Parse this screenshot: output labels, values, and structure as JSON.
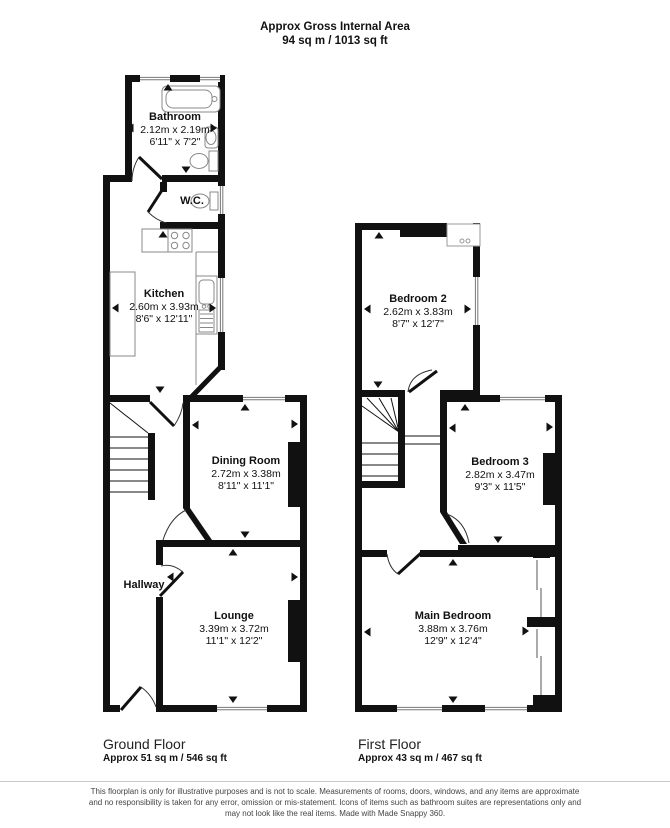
{
  "header": {
    "title": "Approx Gross Internal Area",
    "area": "94 sq m / 1013 sq ft"
  },
  "ground_floor": {
    "title": "Ground Floor",
    "area": "Approx 51 sq m / 546 sq ft",
    "rooms": {
      "bathroom": {
        "name": "Bathroom",
        "metric": "2.12m x 2.19m",
        "imperial": "6'11\" x 7'2\""
      },
      "wc": {
        "name": "W.C."
      },
      "kitchen": {
        "name": "Kitchen",
        "metric": "2.60m x 3.93m",
        "imperial": "8'6\" x 12'11\""
      },
      "dining_room": {
        "name": "Dining Room",
        "metric": "2.72m x 3.38m",
        "imperial": "8'11\" x 11'1\""
      },
      "hallway": {
        "name": "Hallway"
      },
      "lounge": {
        "name": "Lounge",
        "metric": "3.39m x 3.72m",
        "imperial": "11'1\" x 12'2\""
      }
    }
  },
  "first_floor": {
    "title": "First Floor",
    "area": "Approx 43 sq m / 467 sq ft",
    "rooms": {
      "bedroom2": {
        "name": "Bedroom 2",
        "metric": "2.62m x 3.83m",
        "imperial": "8'7\" x 12'7\""
      },
      "bedroom3": {
        "name": "Bedroom 3",
        "metric": "2.82m x 3.47m",
        "imperial": "9'3\" x 11'5\""
      },
      "main_bedroom": {
        "name": "Main Bedroom",
        "metric": "3.88m x 3.76m",
        "imperial": "12'9\" x 12'4\""
      }
    }
  },
  "disclaimer": {
    "line1": "This floorplan is only for illustrative purposes and is not to scale. Measurements of rooms, doors, windows, and any items are approximate",
    "line2": "and no responsibility is taken for any error, omission or mis-statement. Icons of items such as bathroom suites are representations only and",
    "line3": "may not look like the real items. Made with Made Snappy 360."
  },
  "icons": {
    "bathtub": "bathtub-icon",
    "toilet": "toilet-icon",
    "basin": "basin-icon",
    "stove": "stove-icon",
    "kitchen_sink": "kitchen-sink-icon",
    "stairs": "stairs-icon",
    "measure_arrow": "measure-arrow-icon"
  },
  "colors": {
    "wall": "#111111",
    "background": "#ffffff",
    "fixture_stroke": "#888888"
  }
}
